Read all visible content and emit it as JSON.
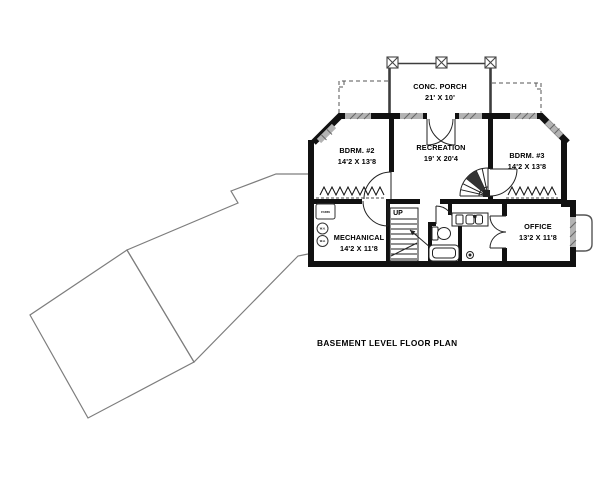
{
  "drawing": {
    "caption": "BASEMENT LEVEL FLOOR PLAN",
    "rooms": {
      "porch": {
        "name": "CONC. PORCH",
        "dims": "21' X 10'"
      },
      "bdrm2": {
        "name": "BDRM. #2",
        "dims": "14'2 X 13'8"
      },
      "recreation": {
        "name": "RECREATION",
        "dims": "19' X 20'4"
      },
      "bdrm3": {
        "name": "BDRM. #3",
        "dims": "14'2 X 13'8"
      },
      "mechanical": {
        "name": "MECHANICAL",
        "dims": "14'2 X 11'8"
      },
      "office": {
        "name": "OFFICE",
        "dims": "13'2 X 11'8"
      }
    },
    "annotations": {
      "up": "UP",
      "furnace": "FURN",
      "water_heater": "W.H."
    },
    "colors": {
      "wall": "#111111",
      "window": "#b3b3b3",
      "porch_wall": "#3d3d3d",
      "footprint_outline": "#7d7d7d",
      "dashed": "#555555",
      "background": "#ffffff"
    }
  }
}
